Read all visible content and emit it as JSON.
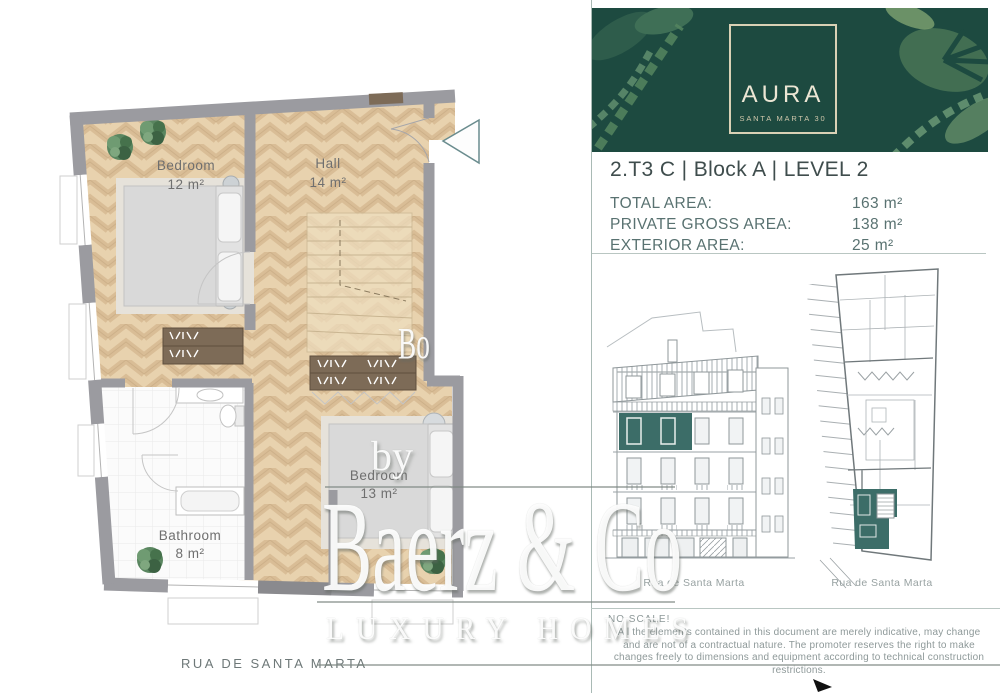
{
  "brand": {
    "name": "AURA",
    "subtitle": "SANTA MARTA 30"
  },
  "unit": {
    "title": "2.T3 C | Block A | LEVEL 2",
    "areas": [
      {
        "label": "TOTAL AREA:",
        "value": "163 m²"
      },
      {
        "label": "PRIVATE GROSS AREA:",
        "value": "138 m²"
      },
      {
        "label": "EXTERIOR AREA:",
        "value": "25 m²"
      }
    ]
  },
  "floorplan": {
    "rooms": [
      {
        "name": "Bedroom",
        "area": "12 m²"
      },
      {
        "name": "Hall",
        "area": "14 m²"
      },
      {
        "name": "Bedroom",
        "area": "13 m²"
      },
      {
        "name": "Bathroom",
        "area": "8 m²"
      }
    ],
    "street": "RUA DE SANTA MARTA"
  },
  "drawings": {
    "elevation_caption": "Rua de Santa Marta",
    "siteplan_caption": "Rua de Santa Marta"
  },
  "notes": {
    "scale": "NO SCALE!",
    "disclaimer": "All the elements contained in this document are merely indicative, may change and are not of a contractual nature. The promoter reserves the right to make changes freely to dimensions and equipment according to technical construction restrictions."
  },
  "watermark": {
    "prefix": "by",
    "name": "Baerz & Co",
    "tagline": "LUXURY HOMES",
    "fragment": "Bo"
  },
  "colors": {
    "accent_teal": "#3c6d68",
    "header_green": "#1d4a40",
    "wall_gray": "#9b9ba0",
    "floor_tan": "#e8d2ae"
  }
}
